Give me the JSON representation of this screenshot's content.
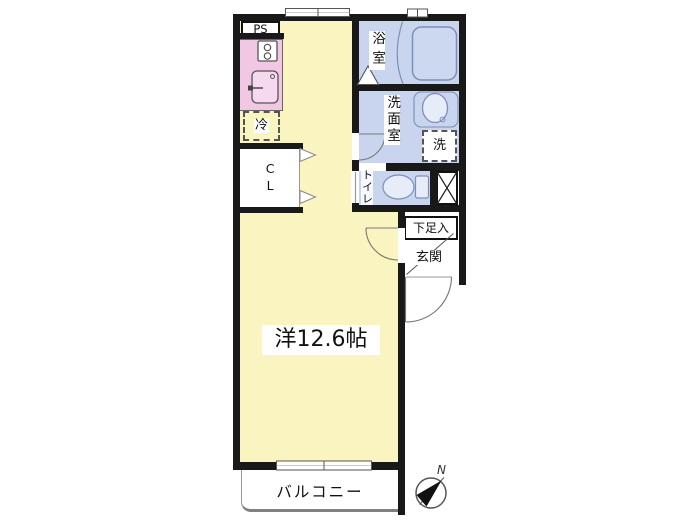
{
  "plan": {
    "rooms": {
      "main_room": "洋12.6帖",
      "bath": "浴室",
      "washroom": "洗面室",
      "toilet": "トイレ",
      "entrance": "玄関",
      "shoe_cabinet": "下足入",
      "balcony": "バルコニー",
      "closet": "CL",
      "pipe_space": "PS",
      "refrigerator": "冷",
      "washing_machine": "洗"
    },
    "compass": {
      "north_label": "N"
    },
    "colors": {
      "room_yellow": "#faf4c0",
      "wet_area_blue": "#c9d5ee",
      "kitchen_pink": "#f1c7e3",
      "wall_black": "#191919",
      "fixture_stroke_blue": "#7d8fb8"
    }
  }
}
